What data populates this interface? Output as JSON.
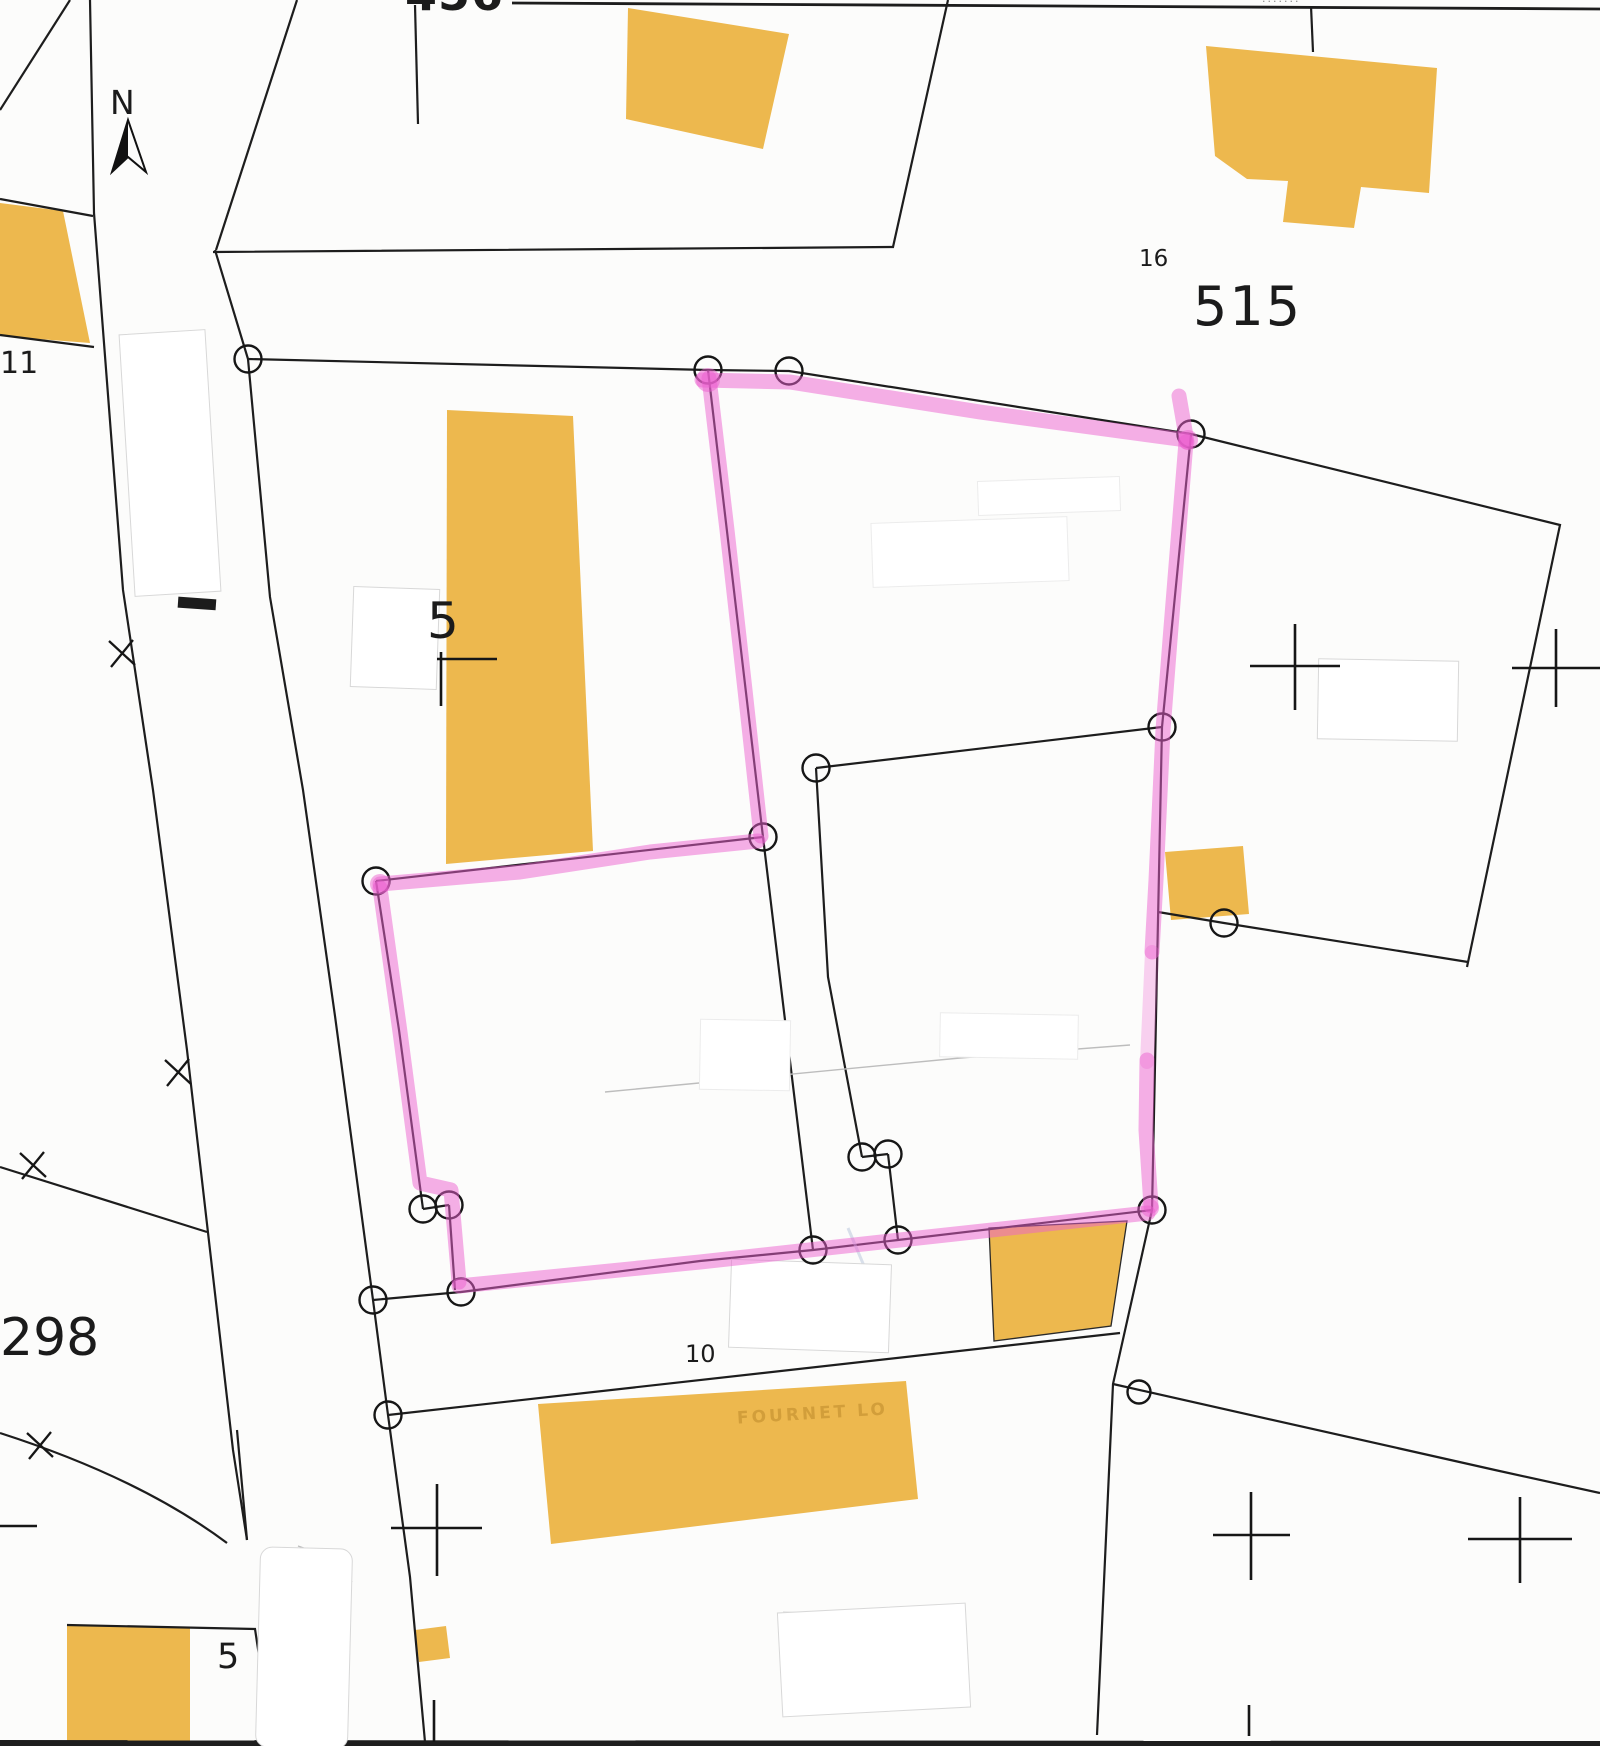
{
  "labels": {
    "parcel_456": "456",
    "parcel_515": "515",
    "parcel_16": "16",
    "parcel_298": "298",
    "parcel_11": "11",
    "parcel_10": "10",
    "parcel_5_center": "5",
    "parcel_5_bottom": "5",
    "north": "N",
    "building_name_faint": "FOURNET LO",
    "top_edge_cut_text": "·······"
  },
  "icons": {
    "north_arrow_icon": "north-arrow"
  },
  "colors": {
    "background": "#fcfcfb",
    "parcel_line": "#1d1d1d",
    "building_fill": "#edb84e",
    "highlight_pink": "#ec5fd0",
    "patch_border": "#d8d8d8",
    "faint_line": "#bdbdbd"
  }
}
